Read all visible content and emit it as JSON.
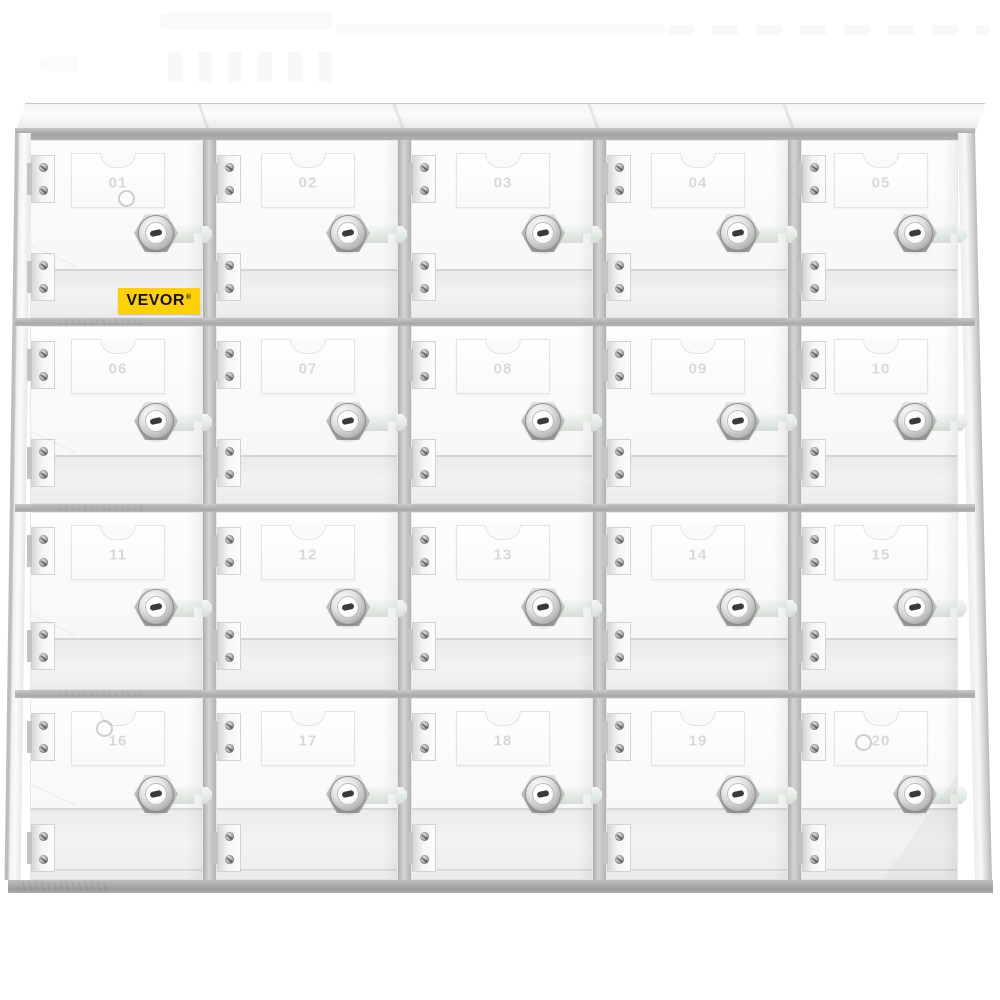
{
  "product": {
    "title": "Clear acrylic 20-door locker cabinet",
    "brand_badge": {
      "text": "VEVOR",
      "registered_mark": "®"
    },
    "grid": {
      "rows": 4,
      "columns": 5,
      "total_doors": 20
    },
    "locker_numbers": [
      "01",
      "02",
      "03",
      "04",
      "05",
      "06",
      "07",
      "08",
      "09",
      "10",
      "11",
      "12",
      "13",
      "14",
      "15",
      "16",
      "17",
      "18",
      "19",
      "20"
    ],
    "hardware": {
      "lock": "cam-lock-icon",
      "hinge": "hinge-icon",
      "label_card": "number-card"
    }
  },
  "colors": {
    "background": "#ffffff",
    "brand_badge_yellow": "#fdd104",
    "brand_text_black": "#111111",
    "frame_gray": "#aaaaaa",
    "door_white": "#fafafa",
    "number_watermark_gray": "#d8d8d8",
    "lock_metal_gray": "#9b9b9b"
  }
}
